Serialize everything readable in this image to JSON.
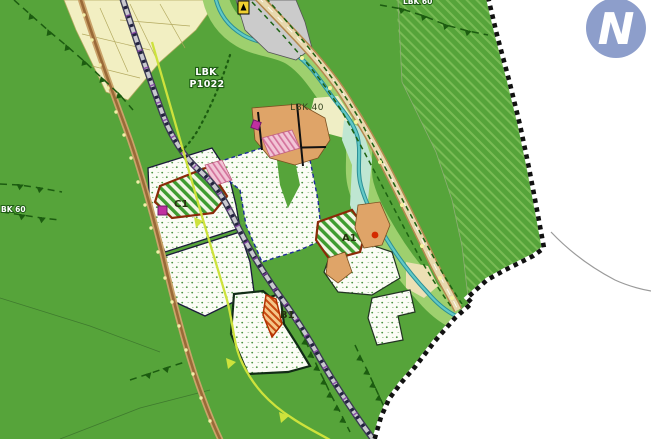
{
  "map": {
    "kind": "land-use-development-plan",
    "labels": {
      "lbk40": "LBK 40",
      "lbk_p1022_line1": "LBK",
      "lbk_p1022_line2": "P1022",
      "lbk60_left": "BK 60",
      "lbk60_top": "LBK 60",
      "zone_c1": "C1",
      "zone_a1": "A1",
      "zone_b1": "B1"
    },
    "colors": {
      "background_green": "#56a43a",
      "forest_hatch_stripe": "#79bb55",
      "farmland_yellow": "#f2efc2",
      "riparian_light_green": "#9ed06e",
      "stream_teal": "#62c9c6",
      "road_tan_fill": "#e8d9ae",
      "road_brown": "#9a6a38",
      "gray_road": "#c9c9cf",
      "plan_boundary": "#111111",
      "zone_hatch_green": "#3f9c30",
      "zone_border_red_brown": "#8a2a08",
      "marker_magenta": "#c030a0",
      "path_chartreuse": "#cde23c",
      "outside_area": "#ffffff"
    },
    "logo": {
      "letter": "N",
      "circle_color": "#8d9ecb",
      "letter_color": "#ffffff"
    }
  }
}
